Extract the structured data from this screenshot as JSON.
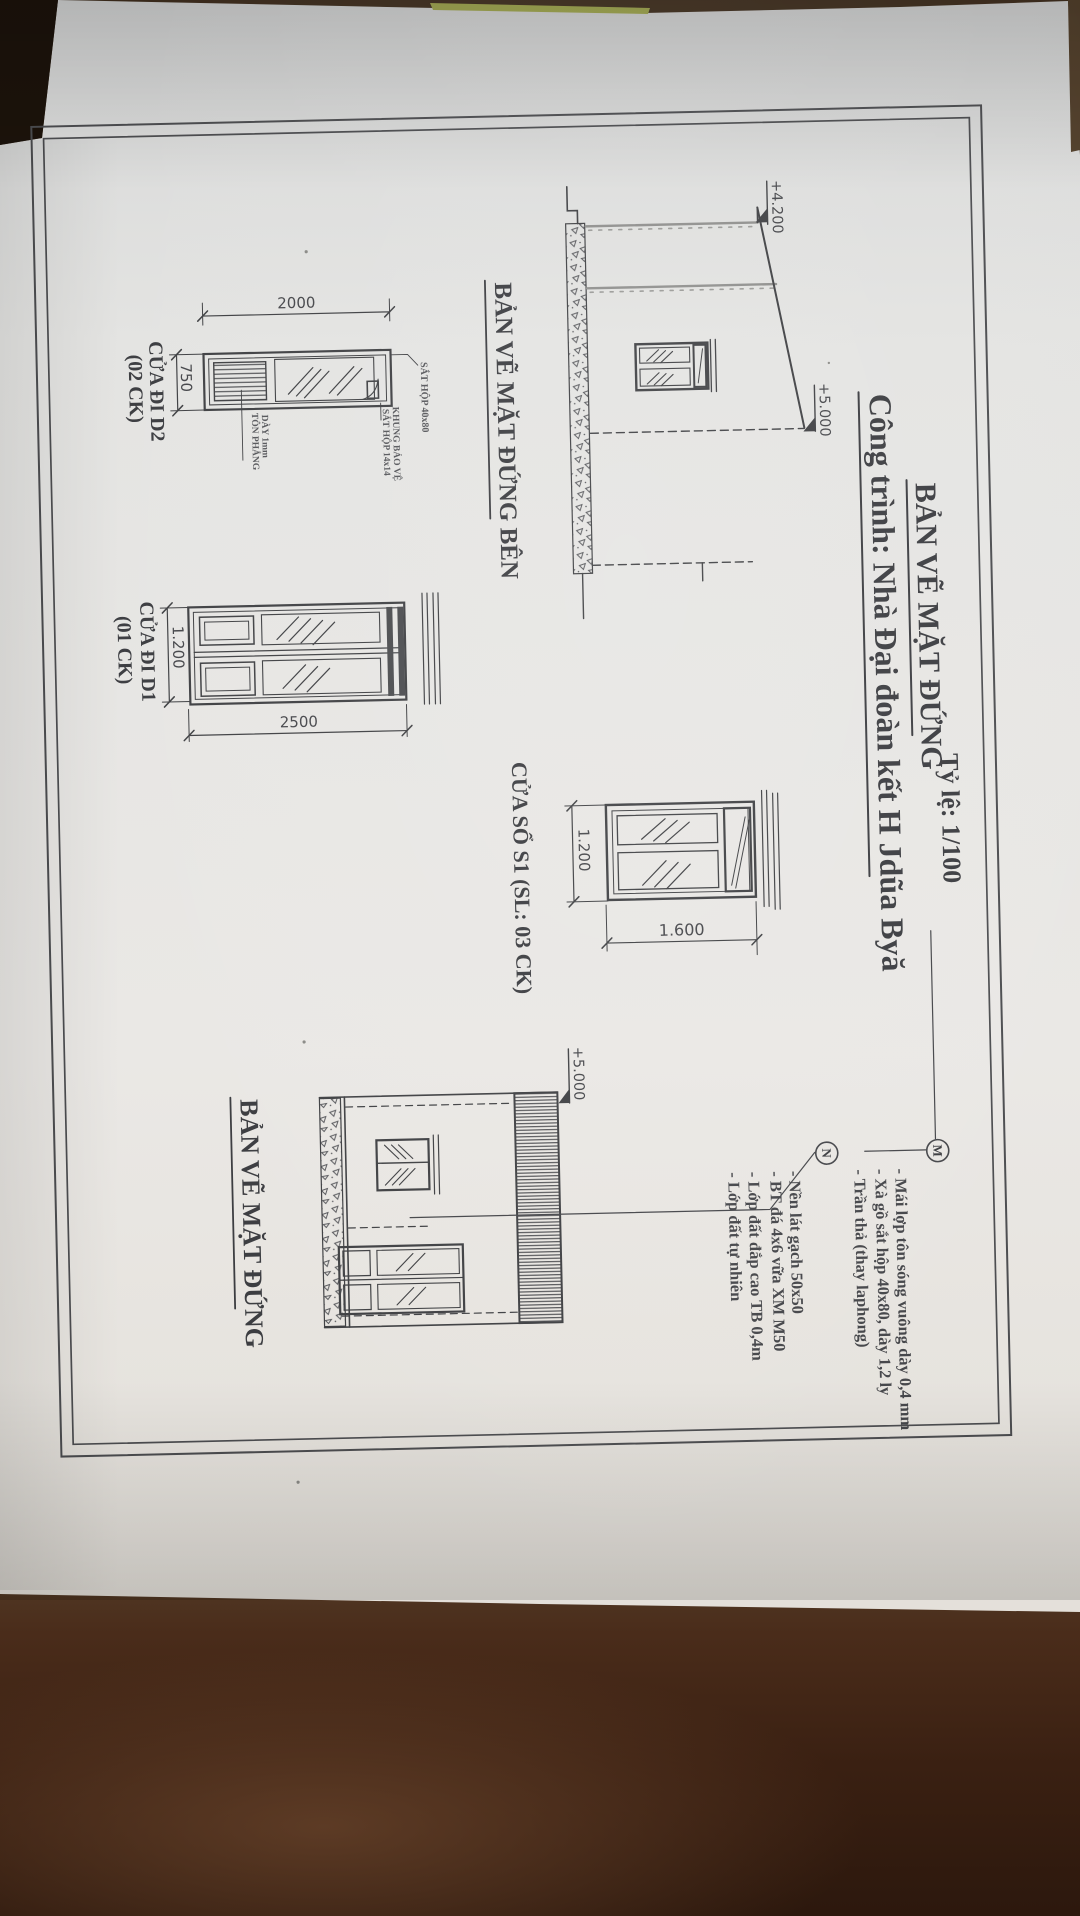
{
  "title_block": {
    "title": "BẢN VẼ MẶT ĐỨNG",
    "scale": "Tỷ lệ: 1/100",
    "project": "Công trình: Nhà Đại đoàn kết H Jdũa Byă"
  },
  "labels": {
    "side_elevation": "BẢN VẼ MẶT ĐỨNG BÊN",
    "front_elevation": "BẢN VẼ MẶT ĐỨNG",
    "window_s1": "CỬA SỔ S1 (SL: 03 CK)",
    "door_d2": "CỬA ĐI D2",
    "door_d2_count": "(02 CK)",
    "door_d1": "CỬA ĐI D1",
    "door_d1_count": "(01 CK)"
  },
  "dimensions": {
    "d2_width": "2000",
    "d2_height": "750",
    "d1_height": "2500",
    "d1_width": "1.200",
    "s1_height": "1.200",
    "s1_width": "1.600"
  },
  "levels": {
    "side_eave": "+4.200",
    "side_ridge": "+5.000",
    "front_parapet": "+5.000"
  },
  "annotations": {
    "d2_frame": "SẮT HỘP 40x80",
    "d2_sheet_1": "TÔN PHẲNG",
    "d2_sheet_2": "DÀY 1mm",
    "d2_guard_1": "KHUNG BẢO VỆ",
    "d2_guard_2": "SẮT HỘP 14x14"
  },
  "notes": {
    "m_symbol": "M",
    "m_line_1": "- Mái lợp tôn sóng vuông dày 0,4 mm",
    "m_line_2": "- Xà gồ sắt hộp 40x80, dày 1,2 ly",
    "m_line_3": "- Trần thả (thay laphong)",
    "n_symbol": "N",
    "n_line_1": "- Nền lát gạch 50x50",
    "n_line_2": "- BT đá 4x6 vữa XM M50",
    "n_line_3": "- Lớp đất đắp cao TB 0,4m",
    "n_line_4": "- Lớp đất tự nhiên"
  },
  "colors": {
    "paper": "#e7e6e2",
    "ink": "#3f4043",
    "table_dark": "#2f1a0e",
    "table_light": "#5e3a24",
    "mat_green": "#9aa949"
  }
}
